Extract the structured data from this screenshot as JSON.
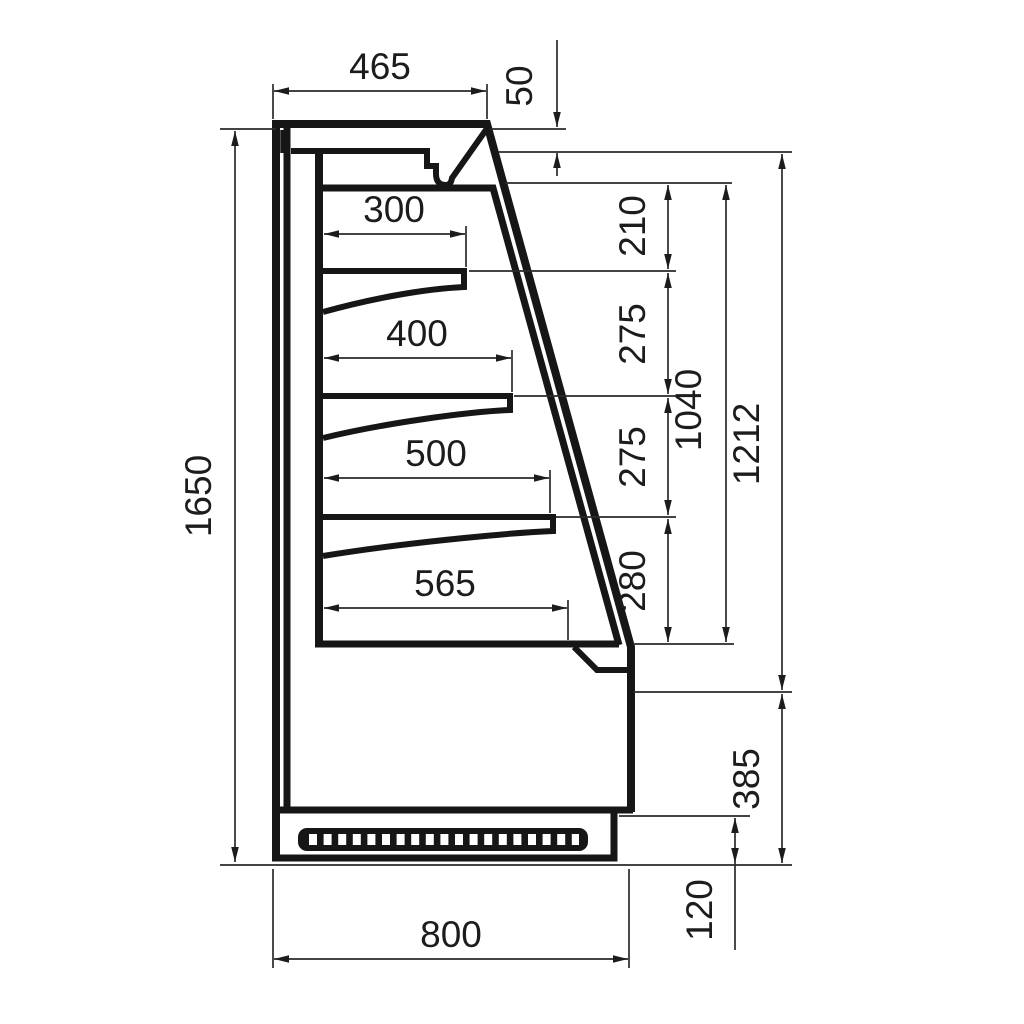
{
  "drawing": {
    "background": "#ffffff",
    "line_color": "#161616"
  },
  "dims": {
    "top_depth": "465",
    "canopy_height": "50",
    "shelf1_depth": "300",
    "shelf2_depth": "400",
    "shelf3_depth": "500",
    "base_shelf_depth": "565",
    "gap_top": "210",
    "gap_upper": "275",
    "gap_lower": "275",
    "gap_bottom": "280",
    "interior_height": "1040",
    "front_height": "1212",
    "total_height": "1650",
    "lower_front_height": "385",
    "plinth_height": "120",
    "total_depth": "800"
  }
}
